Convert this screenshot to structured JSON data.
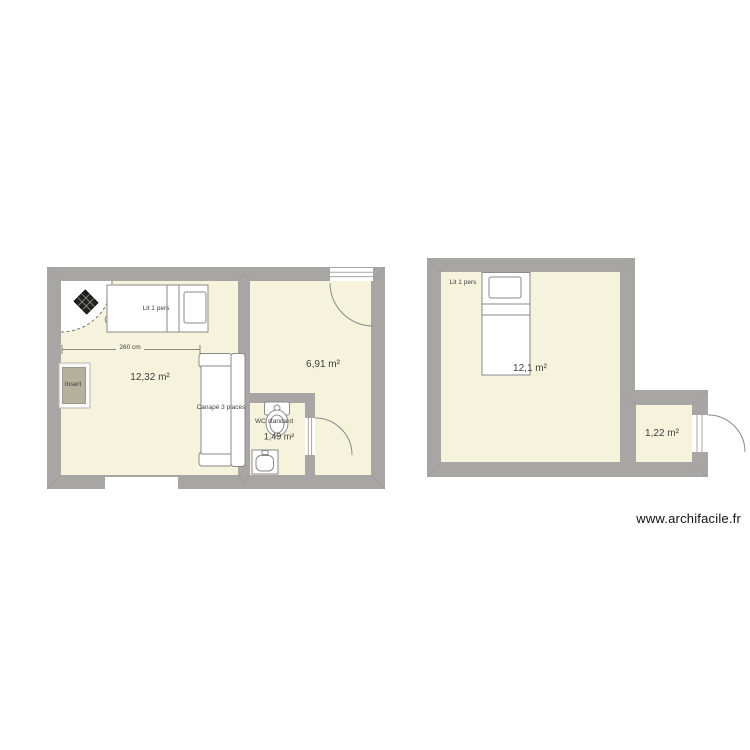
{
  "watermark": "www.archifacile.fr",
  "colors": {
    "wall": "#a8a6a4",
    "floor": "#f6f3dd",
    "outline": "#8a8a8a"
  },
  "plan_left": {
    "dimension_label": "260 cm",
    "room_areas": [
      "12,32 m²",
      "6,91 m²",
      "1,49 m²"
    ],
    "furniture_labels": {
      "bed": "Lit 1 pers",
      "sofa": "Canapé 3 places",
      "toilet": "WC standard",
      "insert": "Insert"
    }
  },
  "plan_right": {
    "room_areas": [
      "12,1 m²",
      "1,22 m²"
    ],
    "furniture_labels": {
      "bed": "Lit 1 pers"
    }
  }
}
